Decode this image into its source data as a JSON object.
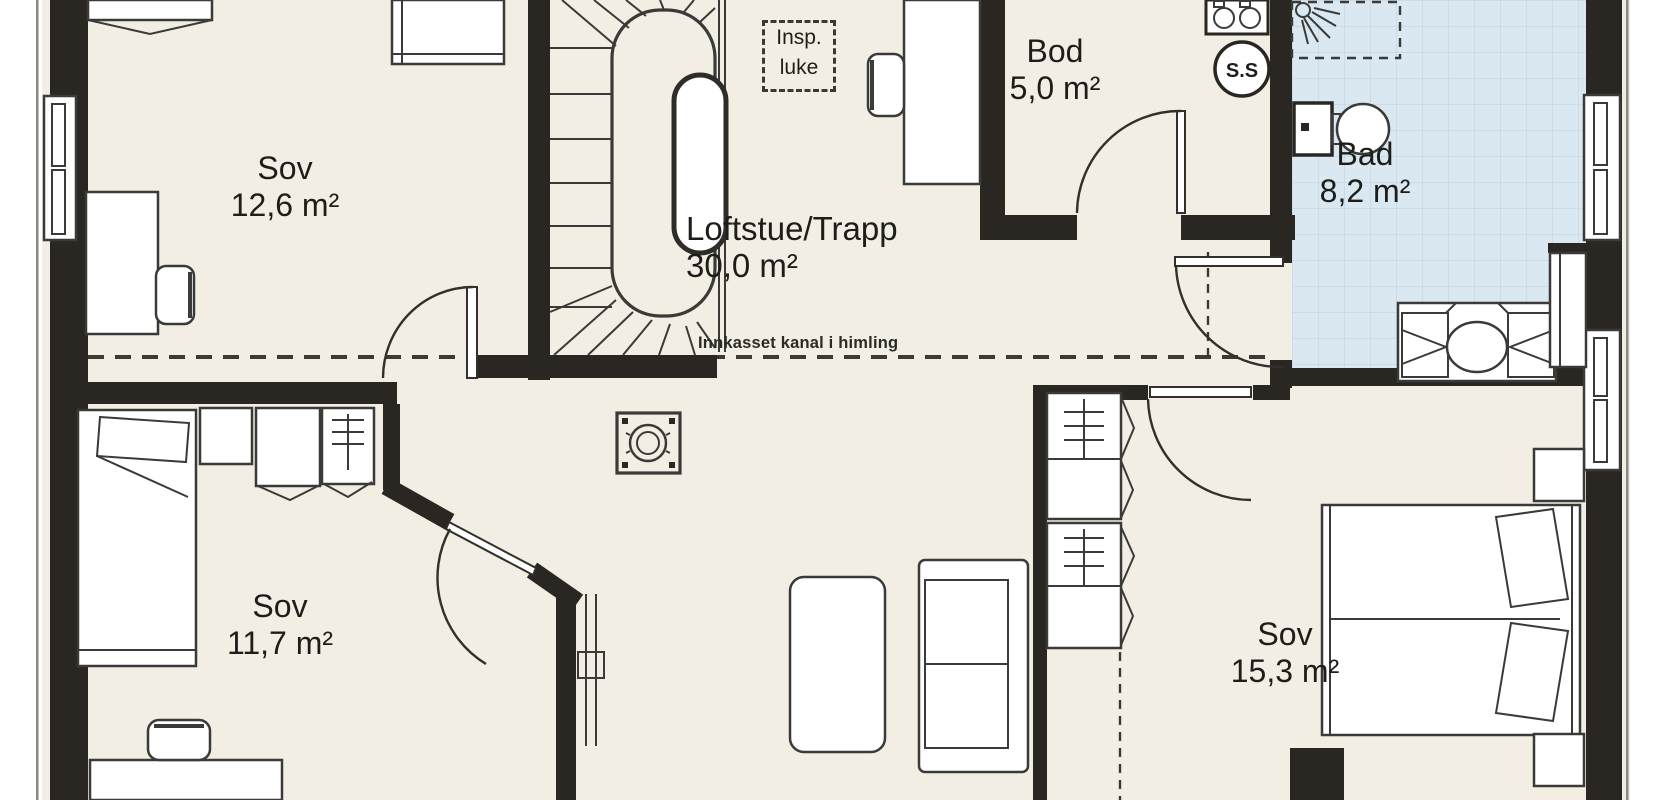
{
  "plan": {
    "rooms": [
      {
        "id": "sov-topleft",
        "name": "Sov",
        "area": "12,6 m²"
      },
      {
        "id": "loftstue",
        "name": "Loftstue/Trapp",
        "area": "30,0 m²"
      },
      {
        "id": "bod",
        "name": "Bod",
        "area": "5,0 m²"
      },
      {
        "id": "bad",
        "name": "Bad",
        "area": "8,2 m²"
      },
      {
        "id": "sov-bottomleft",
        "name": "Sov",
        "area": "11,7 m²"
      },
      {
        "id": "sov-right",
        "name": "Sov",
        "area": "15,3 m²"
      }
    ],
    "annotations": {
      "hatch_line1": "Insp.",
      "hatch_line2": "luke",
      "duct_note": "Innkasset kanal i himling",
      "ss_label": "S.S"
    },
    "fixtures": [
      "staircase",
      "toilet",
      "shower",
      "vanity-sink",
      "stove-top",
      "vent-chimney",
      "sofa",
      "coffee-table",
      "double-bed",
      "single-bed",
      "wardrobe",
      "desk",
      "chair",
      "window"
    ],
    "colors": {
      "floor": "#f3eee3",
      "wall": "#2a2723",
      "line": "#3a3a38",
      "bath_floor": "#d9e8f1",
      "tile_line": "#c2d5e2",
      "text": "#1e1d1a",
      "outside": "#ffffff"
    }
  }
}
